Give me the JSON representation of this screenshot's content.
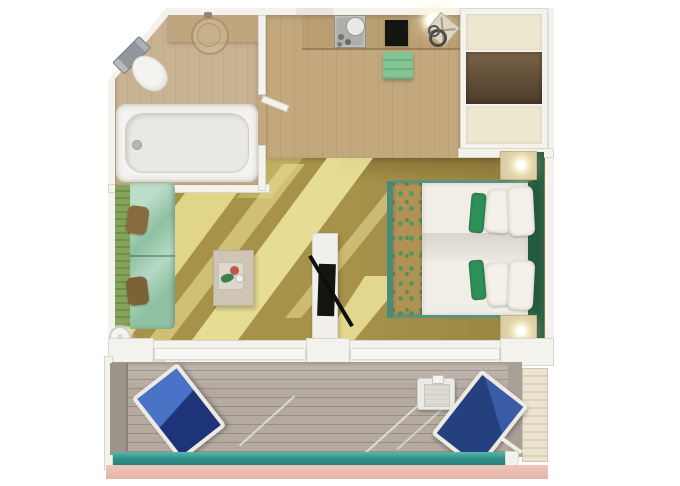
{
  "scene": {
    "type": "floor-plan",
    "subject": "cruise-ship balcony stateroom, top-down 3D rendering",
    "visible_text": []
  },
  "palette": {
    "wall": "#f4f2ed",
    "wallEdge": "#d9d6cf",
    "pageBg": "#ffffff",
    "bathFloor": "#c9b291",
    "bathCounter": "#c0a67f",
    "corridorFloor": "#c2a87c",
    "carpet": "#a69249",
    "lightBeam": "#f0e6a4",
    "wardrobeCream": "#efe8d1",
    "wardrobeDoorTop": "#7a6448",
    "wardrobeDoorBottom": "#4e3c29",
    "sofaBack": "#84a45c",
    "sofaBackRib": "#6f9048",
    "sofaSeat": "#8fc0a1",
    "pillowBrown": "#8a6b3f",
    "coffeeTable": "#cfc5b5",
    "tvBlack": "#131511",
    "consoleWhite": "#f1efe9",
    "bedRunner": "#b29254",
    "runnerLeaf": "#4e9960",
    "mattress": "#f1eee7",
    "bedFrame": "#4a8a78",
    "headboard": "#245b3e",
    "wallPanelGreen": "#2e5f42",
    "greenPillow": "#2f8f58",
    "pillowWhite": "#f4f1ea",
    "nightstand": "#d8cba2",
    "deck": "#b4aaa0",
    "deckLine": "#a3998f",
    "railingLight": "#5cb6ae",
    "railing": "#2e9189",
    "railingDark": "#1e7b74",
    "pinkLedge": "#e3b5a8",
    "pinkLedgeLight": "#eec6ba",
    "loungeBlue": "#4a72c6",
    "loungeNavy": "#1d3578",
    "loungeNavy2": "#24407e",
    "loungeNavy2Light": "#3a5ca6",
    "dividerGray": "#9d958c",
    "slatLight": "#ece4d0",
    "slatDark": "#dbd2bb",
    "benchGreen": "#83c494",
    "trayMetal": "#aeaeaa",
    "fixtureWhite": "#f4f3f0",
    "tubInner": "#e9e8e4",
    "toiletTank": "#8f979c"
  },
  "rooms": [
    {
      "id": "bathroom",
      "corner": "angled top-left",
      "furniture": [
        "toilet",
        "vanity-basin",
        "bathtub"
      ]
    },
    {
      "id": "entry-corridor",
      "furniture": [
        "vanity-desk",
        "metal-tray",
        "desk-pad",
        "desk-lamp",
        "desk-chair",
        "green-bench"
      ]
    },
    {
      "id": "wardrobe",
      "furniture": [
        "closet-top-shelf",
        "open-closet",
        "closet-bottom-shelf"
      ]
    },
    {
      "id": "living-area",
      "furniture": [
        "sofa",
        "sofa-pillows",
        "floor-lamp",
        "coffee-table",
        "tv-partition",
        "tv"
      ]
    },
    {
      "id": "bedroom",
      "furniture": [
        "double-bed",
        "bed-runner",
        "white-pillows",
        "green-accent-pillows",
        "headboard",
        "nightstand-top",
        "nightstand-bottom",
        "bedside-lamps"
      ]
    },
    {
      "id": "balcony",
      "furniture": [
        "lounge-chair-left",
        "lounge-chair-right",
        "side-table",
        "privacy-divider-left",
        "slatted-divider-right",
        "teal-railing",
        "outer-ledge"
      ]
    }
  ]
}
